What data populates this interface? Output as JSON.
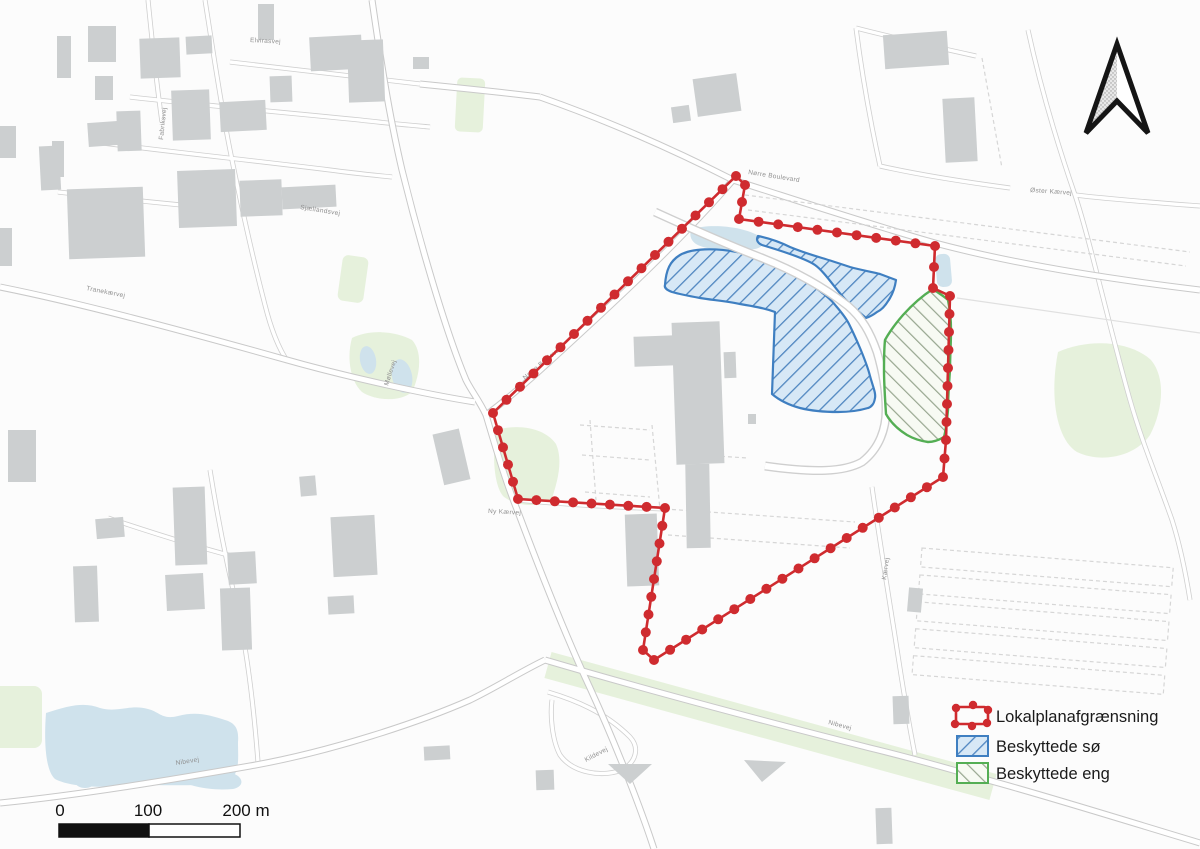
{
  "map": {
    "legend": {
      "items": [
        {
          "label": "Lokalplanafgrænsning",
          "symbol": "boundary-red-dotted",
          "color": "#cf2b2f"
        },
        {
          "label": "Beskyttede sø",
          "symbol": "hatch-blue-diagonal",
          "color": "#3f7fc1"
        },
        {
          "label": "Beskyttede eng",
          "symbol": "hatch-green-diagonal",
          "color": "#54ae54"
        }
      ]
    },
    "scale_bar": {
      "ticks": [
        "0",
        "100",
        "200 m"
      ]
    },
    "north_arrow": {
      "name": "north-arrow"
    },
    "street_labels": [
      {
        "text": "Elvirasvej"
      },
      {
        "text": "Tranekærvej"
      },
      {
        "text": "Sjællandsvej"
      },
      {
        "text": "Fabriksvej"
      },
      {
        "text": "Nørre Boulevard"
      },
      {
        "text": "Nørre Boulevard"
      },
      {
        "text": "Ny Kærvej"
      },
      {
        "text": "Nibevej"
      },
      {
        "text": "Nibevej"
      },
      {
        "text": "Øster Kærvej"
      },
      {
        "text": "Møllevej"
      },
      {
        "text": "Kildevej"
      },
      {
        "text": "Kærvej"
      }
    ],
    "colors": {
      "boundary_red": "#cf2b2f",
      "lake_outline": "#3f7fc1",
      "lake_fill": "#d7e8f6",
      "lake_hatch": "#4f86c0",
      "meadow_outline": "#54ae54",
      "meadow_hatch": "#97a68f",
      "water": "#cfe2ec",
      "greenspace": "#e6f1dc",
      "building": "#cccfd0",
      "road_casing": "#c9c9c9"
    }
  }
}
